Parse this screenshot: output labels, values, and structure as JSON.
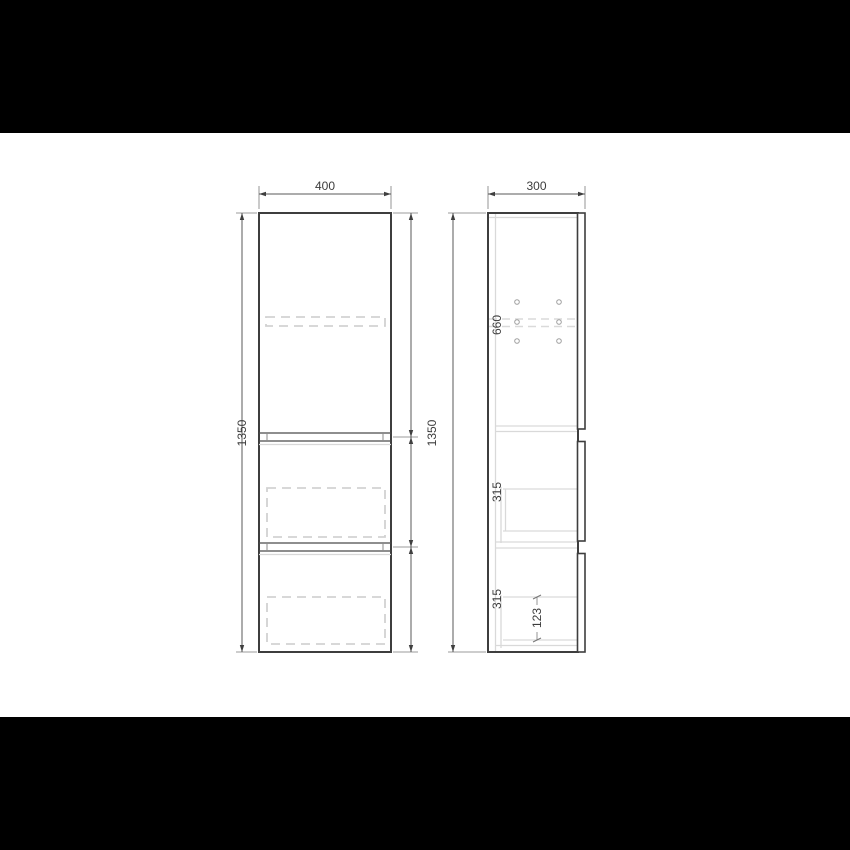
{
  "drawing": {
    "front_view": {
      "width_dim": "400",
      "height_dim": "1350",
      "top_section_dim": "660",
      "middle_section_dim": "315",
      "bottom_section_dim": "315"
    },
    "side_view": {
      "depth_dim": "300",
      "height_dim": "1350",
      "drawer_internal_dim": "123"
    },
    "colors": {
      "letterbox": "#000000",
      "canvas": "#ffffff",
      "outline": "#3e3e3e",
      "hidden_line": "#d2d2d2",
      "dimension_text": "#3c3c3c"
    }
  }
}
